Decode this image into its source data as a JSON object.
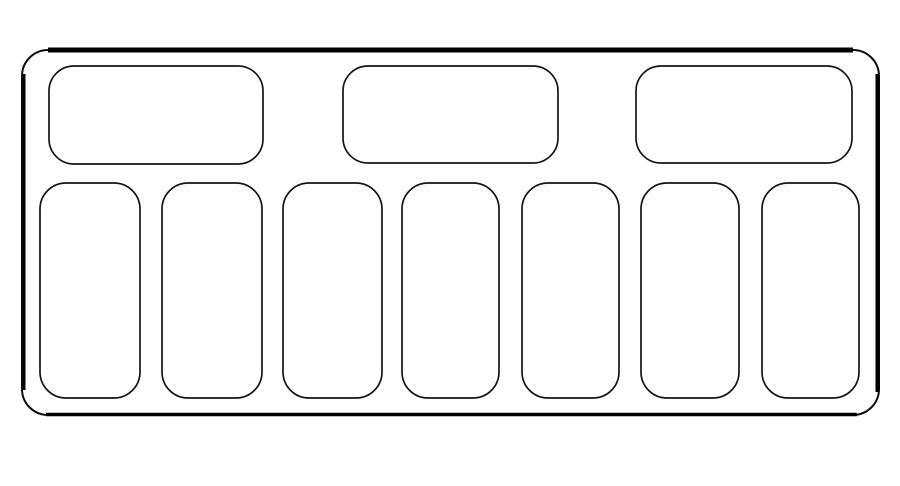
{
  "canvas": {
    "width": 900,
    "height": 486,
    "background_color": "#ffffff",
    "line_color": "#000000",
    "fill_color": "#ffffff"
  },
  "diagram": {
    "kind": "fuse-box-layout-outline",
    "outer_panel": {
      "x": 22,
      "y": 50,
      "width": 857,
      "height": 365,
      "radius": 26,
      "stroke_width": 2
    },
    "edge_accents": [
      {
        "name": "top-edge-accent",
        "x1": 48,
        "y1": 50,
        "x2": 853,
        "y2": 50,
        "stroke_width": 5
      },
      {
        "name": "right-edge-accent",
        "x1": 877.5,
        "y1": 74,
        "x2": 877.5,
        "y2": 392,
        "stroke_width": 4
      },
      {
        "name": "bottom-edge-accent",
        "x1": 46,
        "y1": 414.5,
        "x2": 857,
        "y2": 414.5,
        "stroke_width": 3.5
      },
      {
        "name": "left-edge-accent",
        "x1": 24,
        "y1": 74,
        "x2": 24,
        "y2": 390,
        "stroke_width": 3
      }
    ],
    "top_row_slots": [
      {
        "x": 49,
        "y": 66,
        "width": 214,
        "height": 98,
        "radius": 25
      },
      {
        "x": 343,
        "y": 66,
        "width": 215,
        "height": 97,
        "radius": 25
      },
      {
        "x": 636,
        "y": 66,
        "width": 216,
        "height": 97,
        "radius": 25
      }
    ],
    "bottom_row_slots": [
      {
        "x": 40,
        "y": 183,
        "width": 100,
        "height": 215,
        "radius": 26
      },
      {
        "x": 162,
        "y": 183,
        "width": 100,
        "height": 215,
        "radius": 26
      },
      {
        "x": 283,
        "y": 183,
        "width": 99,
        "height": 215,
        "radius": 26
      },
      {
        "x": 402,
        "y": 183,
        "width": 97,
        "height": 215,
        "radius": 26
      },
      {
        "x": 522,
        "y": 183,
        "width": 97,
        "height": 215,
        "radius": 26
      },
      {
        "x": 641,
        "y": 183,
        "width": 98,
        "height": 215,
        "radius": 26
      },
      {
        "x": 762,
        "y": 183,
        "width": 97,
        "height": 215,
        "radius": 26
      }
    ],
    "slot_stroke_width": 1.7
  }
}
